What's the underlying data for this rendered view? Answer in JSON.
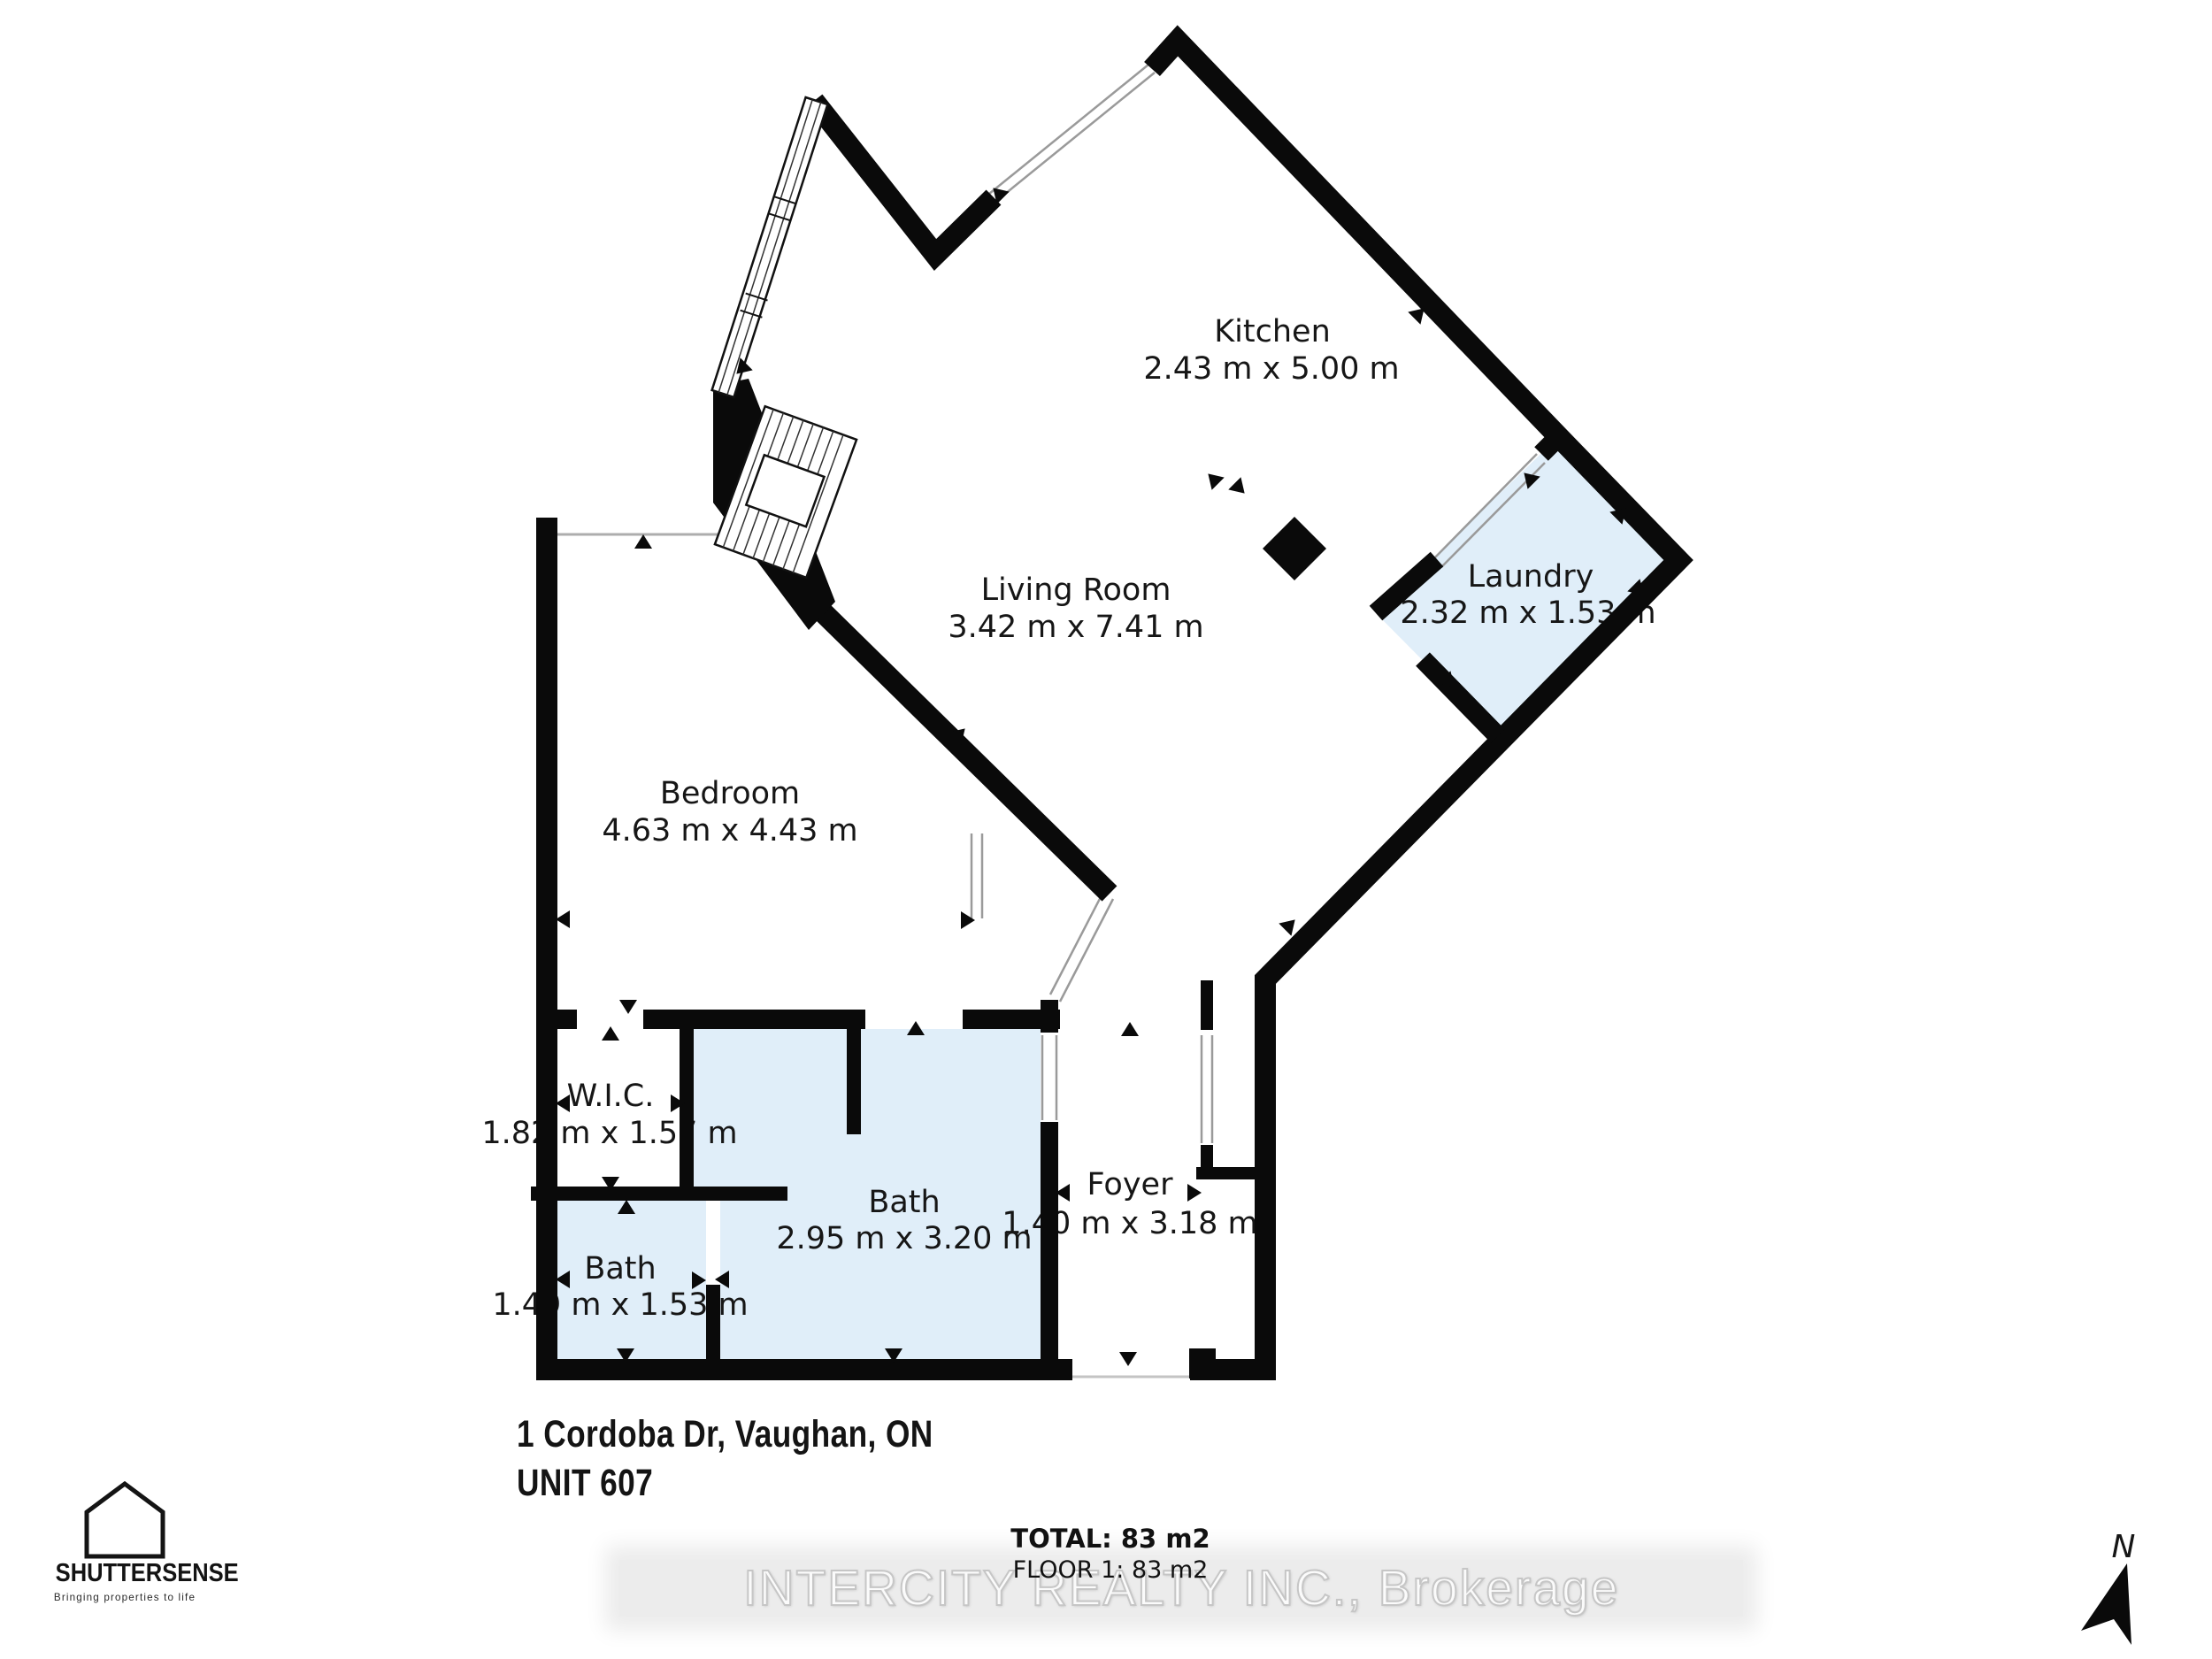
{
  "address": {
    "line1": "1 Cordoba Dr, Vaughan, ON",
    "line2": "UNIT 607"
  },
  "area_summary": {
    "total": "TOTAL: 83 m2",
    "floor": "FLOOR 1: 83 m2"
  },
  "watermark": "INTERCITY REALTY INC., Brokerage",
  "logo": {
    "name": "SHUTTERSENSE",
    "tagline": "Bringing properties to life"
  },
  "compass": {
    "label": "N"
  },
  "rooms": {
    "kitchen": {
      "name": "Kitchen",
      "dims": "2.43 m x 5.00 m"
    },
    "living_room": {
      "name": "Living Room",
      "dims": "3.42 m x 7.41 m"
    },
    "laundry": {
      "name": "Laundry",
      "dims": "2.32 m x 1.53 m"
    },
    "bedroom": {
      "name": "Bedroom",
      "dims": "4.63 m x 4.43 m"
    },
    "wic": {
      "name": "W.I.C.",
      "dims": "1.82 m x 1.57 m"
    },
    "bath_small": {
      "name": "Bath",
      "dims": "1.49 m x 1.53 m"
    },
    "bath_large": {
      "name": "Bath",
      "dims": "2.95 m x 3.20 m"
    },
    "foyer": {
      "name": "Foyer",
      "dims": "1.40 m x 3.18 m"
    }
  },
  "colors": {
    "wall": "#0a0a0a",
    "room_fill": "#e0eef9",
    "watermark_bg": "#ececec"
  }
}
